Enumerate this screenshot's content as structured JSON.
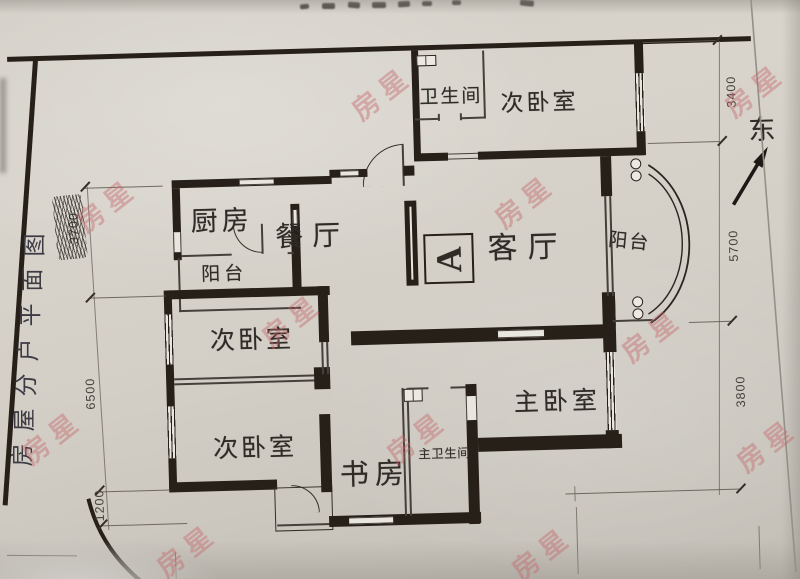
{
  "plan": {
    "side_caption": {
      "text": "房屋分户平面图",
      "chars": [
        "图",
        "面",
        "平",
        "户",
        "分",
        "屋",
        "房"
      ]
    },
    "rooms": {
      "bathroom": "卫生间",
      "bedroom_north": "次卧室",
      "kitchen": "厨房",
      "dining": "餐厅",
      "living": "客厅",
      "balcony_west": "阳台",
      "balcony_east": "阳台",
      "bedroom_mid": "次卧室",
      "bedroom_lower": "次卧室",
      "study": "书房",
      "master_bath": "主卫生间",
      "master_bedroom": "主卧室"
    },
    "marker_a": "A",
    "compass_east": "东",
    "dimensions": {
      "left_3700": "3700",
      "left_6500": "6500",
      "left_1200": "1200",
      "right_3400": "3400",
      "right_5700": "5700",
      "right_3800": "3800"
    }
  },
  "watermark": {
    "text": "房星"
  },
  "colors": {
    "ink": "#262019",
    "paper": "#d4d0c8",
    "watermark": "#c4646a"
  }
}
